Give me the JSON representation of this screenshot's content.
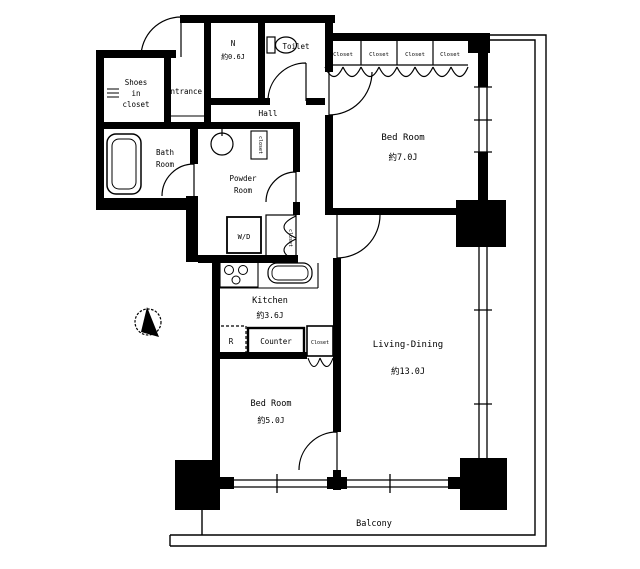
{
  "floor_plan": {
    "rooms": {
      "shoes_closet": {
        "line1": "Shoes",
        "line2": "in",
        "line3": "closet"
      },
      "entrance": {
        "label": "Entrance"
      },
      "storage_n": {
        "label": "N",
        "size": "約0.6J"
      },
      "toilet": {
        "label": "Toilet"
      },
      "hall": {
        "label": "Hall"
      },
      "bath": {
        "line1": "Bath",
        "line2": "Room"
      },
      "powder": {
        "line1": "Powder",
        "line2": "Room"
      },
      "bedroom1": {
        "label": "Bed Room",
        "size": "約7.0J"
      },
      "living_dining": {
        "label": "Living-Dining",
        "size": "約13.0J"
      },
      "kitchen": {
        "label": "Kitchen",
        "size": "約3.6J"
      },
      "bedroom2": {
        "label": "Bed Room",
        "size": "約5.0J"
      },
      "balcony": {
        "label": "Balcony"
      }
    },
    "closet_labels": [
      "Closet",
      "Closet",
      "Closet",
      "Closet"
    ],
    "fixtures": {
      "washer_dryer": "W/D",
      "refrigerator": "R",
      "counter": "Counter",
      "kitchen_closet": "Closet",
      "hall_closet": "closet",
      "powder_closet": "closet"
    },
    "colors": {
      "line": "#000000",
      "background": "#ffffff"
    }
  }
}
